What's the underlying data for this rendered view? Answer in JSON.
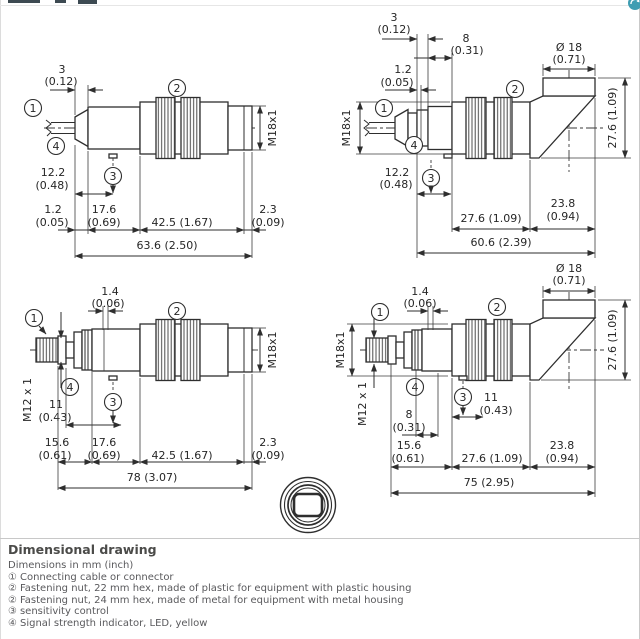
{
  "icons": {
    "corner": "refresh-globe-icon"
  },
  "marks": {
    "m1": "1",
    "m2": "2",
    "m3": "3",
    "m4": "4"
  },
  "tl": {
    "len3": "3",
    "len3_in": "(0.12)",
    "thread": "M18x1",
    "pos122": "12.2",
    "pos122_in": "(0.48)",
    "d12": "1.2",
    "d12_in": "(0.05)",
    "d176": "17.6",
    "d176_in": "(0.69)",
    "d425": "42.5 (1.67)",
    "d23": "2.3",
    "d23_in": "(0.09)",
    "total": "63.6 (2.50)"
  },
  "tr": {
    "len3": "3",
    "len3_in": "(0.12)",
    "d8": "8",
    "d8_in": "(0.31)",
    "d12": "1.2",
    "d12_in": "(0.05)",
    "dia": "Ø 18",
    "dia_in": "(0.71)",
    "thread": "M18x1",
    "h": "27.6 (1.09)",
    "pos122": "12.2",
    "pos122_in": "(0.48)",
    "d276": "27.6 (1.09)",
    "d238": "23.8",
    "d238_in": "(0.94)",
    "total": "60.6 (2.39)"
  },
  "bl": {
    "d14": "1.4",
    "d14_in": "(0.06)",
    "m12": "M12 x 1",
    "thread": "M18x1",
    "d11": "11",
    "d11_in": "(0.43)",
    "d156": "15.6",
    "d156_in": "(0.61)",
    "d176": "17.6",
    "d176_in": "(0.69)",
    "d425": "42.5 (1.67)",
    "d23": "2.3",
    "d23_in": "(0.09)",
    "total": "78 (3.07)"
  },
  "br": {
    "d14": "1.4",
    "d14_in": "(0.06)",
    "dia": "Ø 18",
    "dia_in": "(0.71)",
    "thread": "M18x1",
    "m12": "M12 x 1",
    "h": "27.6 (1.09)",
    "d8": "8",
    "d8_in": "(0.31)",
    "d11": "11",
    "d11_in": "(0.43)",
    "d156": "15.6",
    "d156_in": "(0.61)",
    "d276": "27.6 (1.09)",
    "d238": "23.8",
    "d238_in": "(0.94)",
    "total": "75 (2.95)"
  },
  "footer": {
    "title": "Dimensional drawing",
    "subtitle": "Dimensions in mm (inch)",
    "legend": [
      {
        "num": "①",
        "text": "Connecting cable or connector"
      },
      {
        "num": "②",
        "text": "Fastening nut, 22 mm hex, made of plastic for equipment with plastic housing"
      },
      {
        "num": "②",
        "text": "Fastening nut, 24 mm hex, made of metal for equipment with metal housing"
      },
      {
        "num": "③",
        "text": "sensitivity control"
      },
      {
        "num": "④",
        "text": "Signal strength indicator, LED, yellow"
      }
    ]
  }
}
